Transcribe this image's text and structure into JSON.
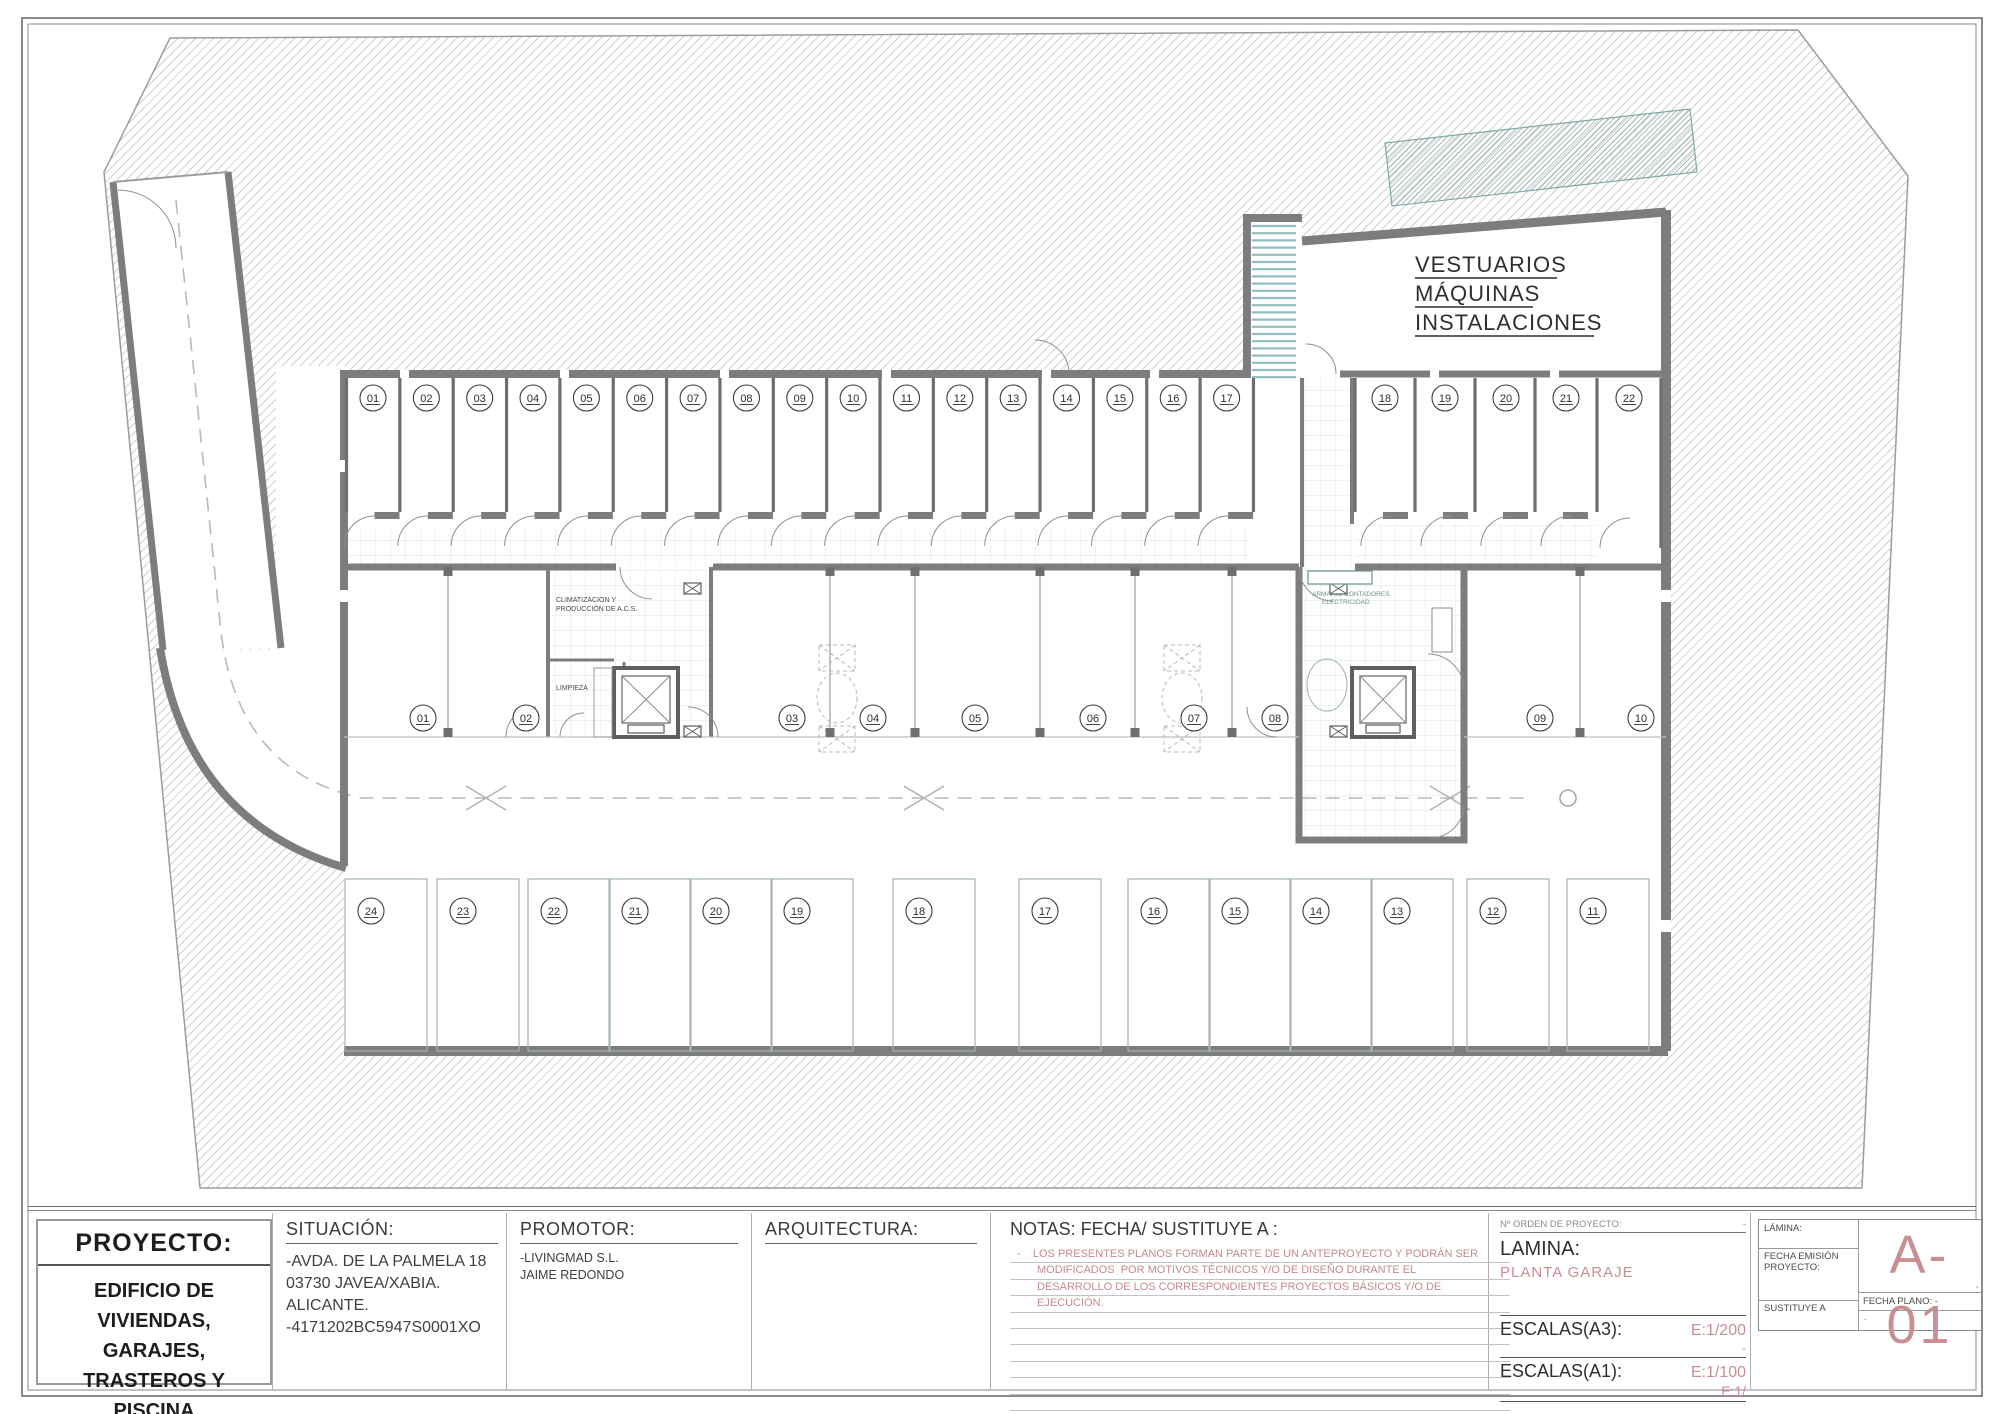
{
  "sheet": {
    "project_label": "PROYECTO:",
    "project_title": "EDIFICIO DE\nVIVIENDAS,\nGARAJES,\nTRASTEROS Y\nPISCINA",
    "situacion_label": "SITUACIÓN:",
    "situacion_lines": "-AVDA. DE LA PALMELA 18\n03730 JAVEA/XABIA. ALICANTE.\n-4171202BC5947S0001XO",
    "promotor_label": "PROMOTOR:",
    "promotor_lines": "-LIVINGMAD S.L.\nJAIME REDONDO",
    "arquitectura_label": "ARQUITECTURA:",
    "notas_label": "NOTAS: FECHA/ SUSTITUYE A :",
    "notas_lines": [
      "-    LOS PRESENTES PLANOS FORMAN PARTE DE UN ANTEPROYECTO Y PODRÁN SER",
      "MODIFICADOS  POR MOTIVOS TÉCNICOS Y/O DE DISEÑO DURANTE EL",
      "DESARROLLO DE LOS CORRESPONDIENTES PROYECTOS BÁSICOS Y/O DE",
      "EJECUCIÓN."
    ],
    "orden_label": "Nº ORDEN DE PROYECTO:",
    "orden_value": "-",
    "lamina_label": "LAMINA:",
    "lamina_value": "PLANTA GARAJE",
    "escalas_a3_label": "ESCALAS(A3):",
    "escalas_a3_value": "E:1/200",
    "escalas_a3_sub": "-",
    "escalas_a1_label": "ESCALAS(A1):",
    "escalas_a1_value": "E:1/100",
    "escalas_a1_sub": "E:1/",
    "corner": {
      "lamina_label": "LÁMINA:",
      "fecha_emision_label": "FECHA EMISIÓN\nPROYECTO:",
      "sustituye_label": "SUSTITUYE A",
      "sheet_code": "A-01",
      "code_dash": "-",
      "fecha_plano_label": "FECHA PLANO:  -",
      "sustituye_value": "-"
    }
  },
  "plan": {
    "room_labels": {
      "vestuarios": [
        "VESTUARIOS",
        "MÁQUINAS",
        "INSTALACIONES"
      ],
      "climatizacion": [
        "CLIMATIZACION Y",
        "PRODUCCIÓN DE A.C.S."
      ],
      "limpieza": "LIMPIEZA",
      "armario": [
        "ARMARIO CONTADORES",
        "ELECTRICIDAD"
      ]
    },
    "storage_units": [
      "01",
      "02",
      "03",
      "04",
      "05",
      "06",
      "07",
      "08",
      "09",
      "10",
      "11",
      "12",
      "13",
      "14",
      "15",
      "16",
      "17",
      "18",
      "19",
      "20",
      "21",
      "22"
    ],
    "parking_middle": [
      "01",
      "02",
      "03",
      "04",
      "05",
      "06",
      "07",
      "08",
      "09",
      "10"
    ],
    "parking_bottom": [
      "24",
      "23",
      "22",
      "21",
      "20",
      "19",
      "18",
      "17",
      "16",
      "15",
      "14",
      "13",
      "12",
      "11"
    ]
  },
  "colors": {
    "wall": "#7d7d7d",
    "hatch": "#c6c6c6",
    "accent_pink": "#c78f92",
    "stair_tread": "#93bdbd",
    "tile": "#dde4e4",
    "parking_outline": "#a3b4b4"
  }
}
